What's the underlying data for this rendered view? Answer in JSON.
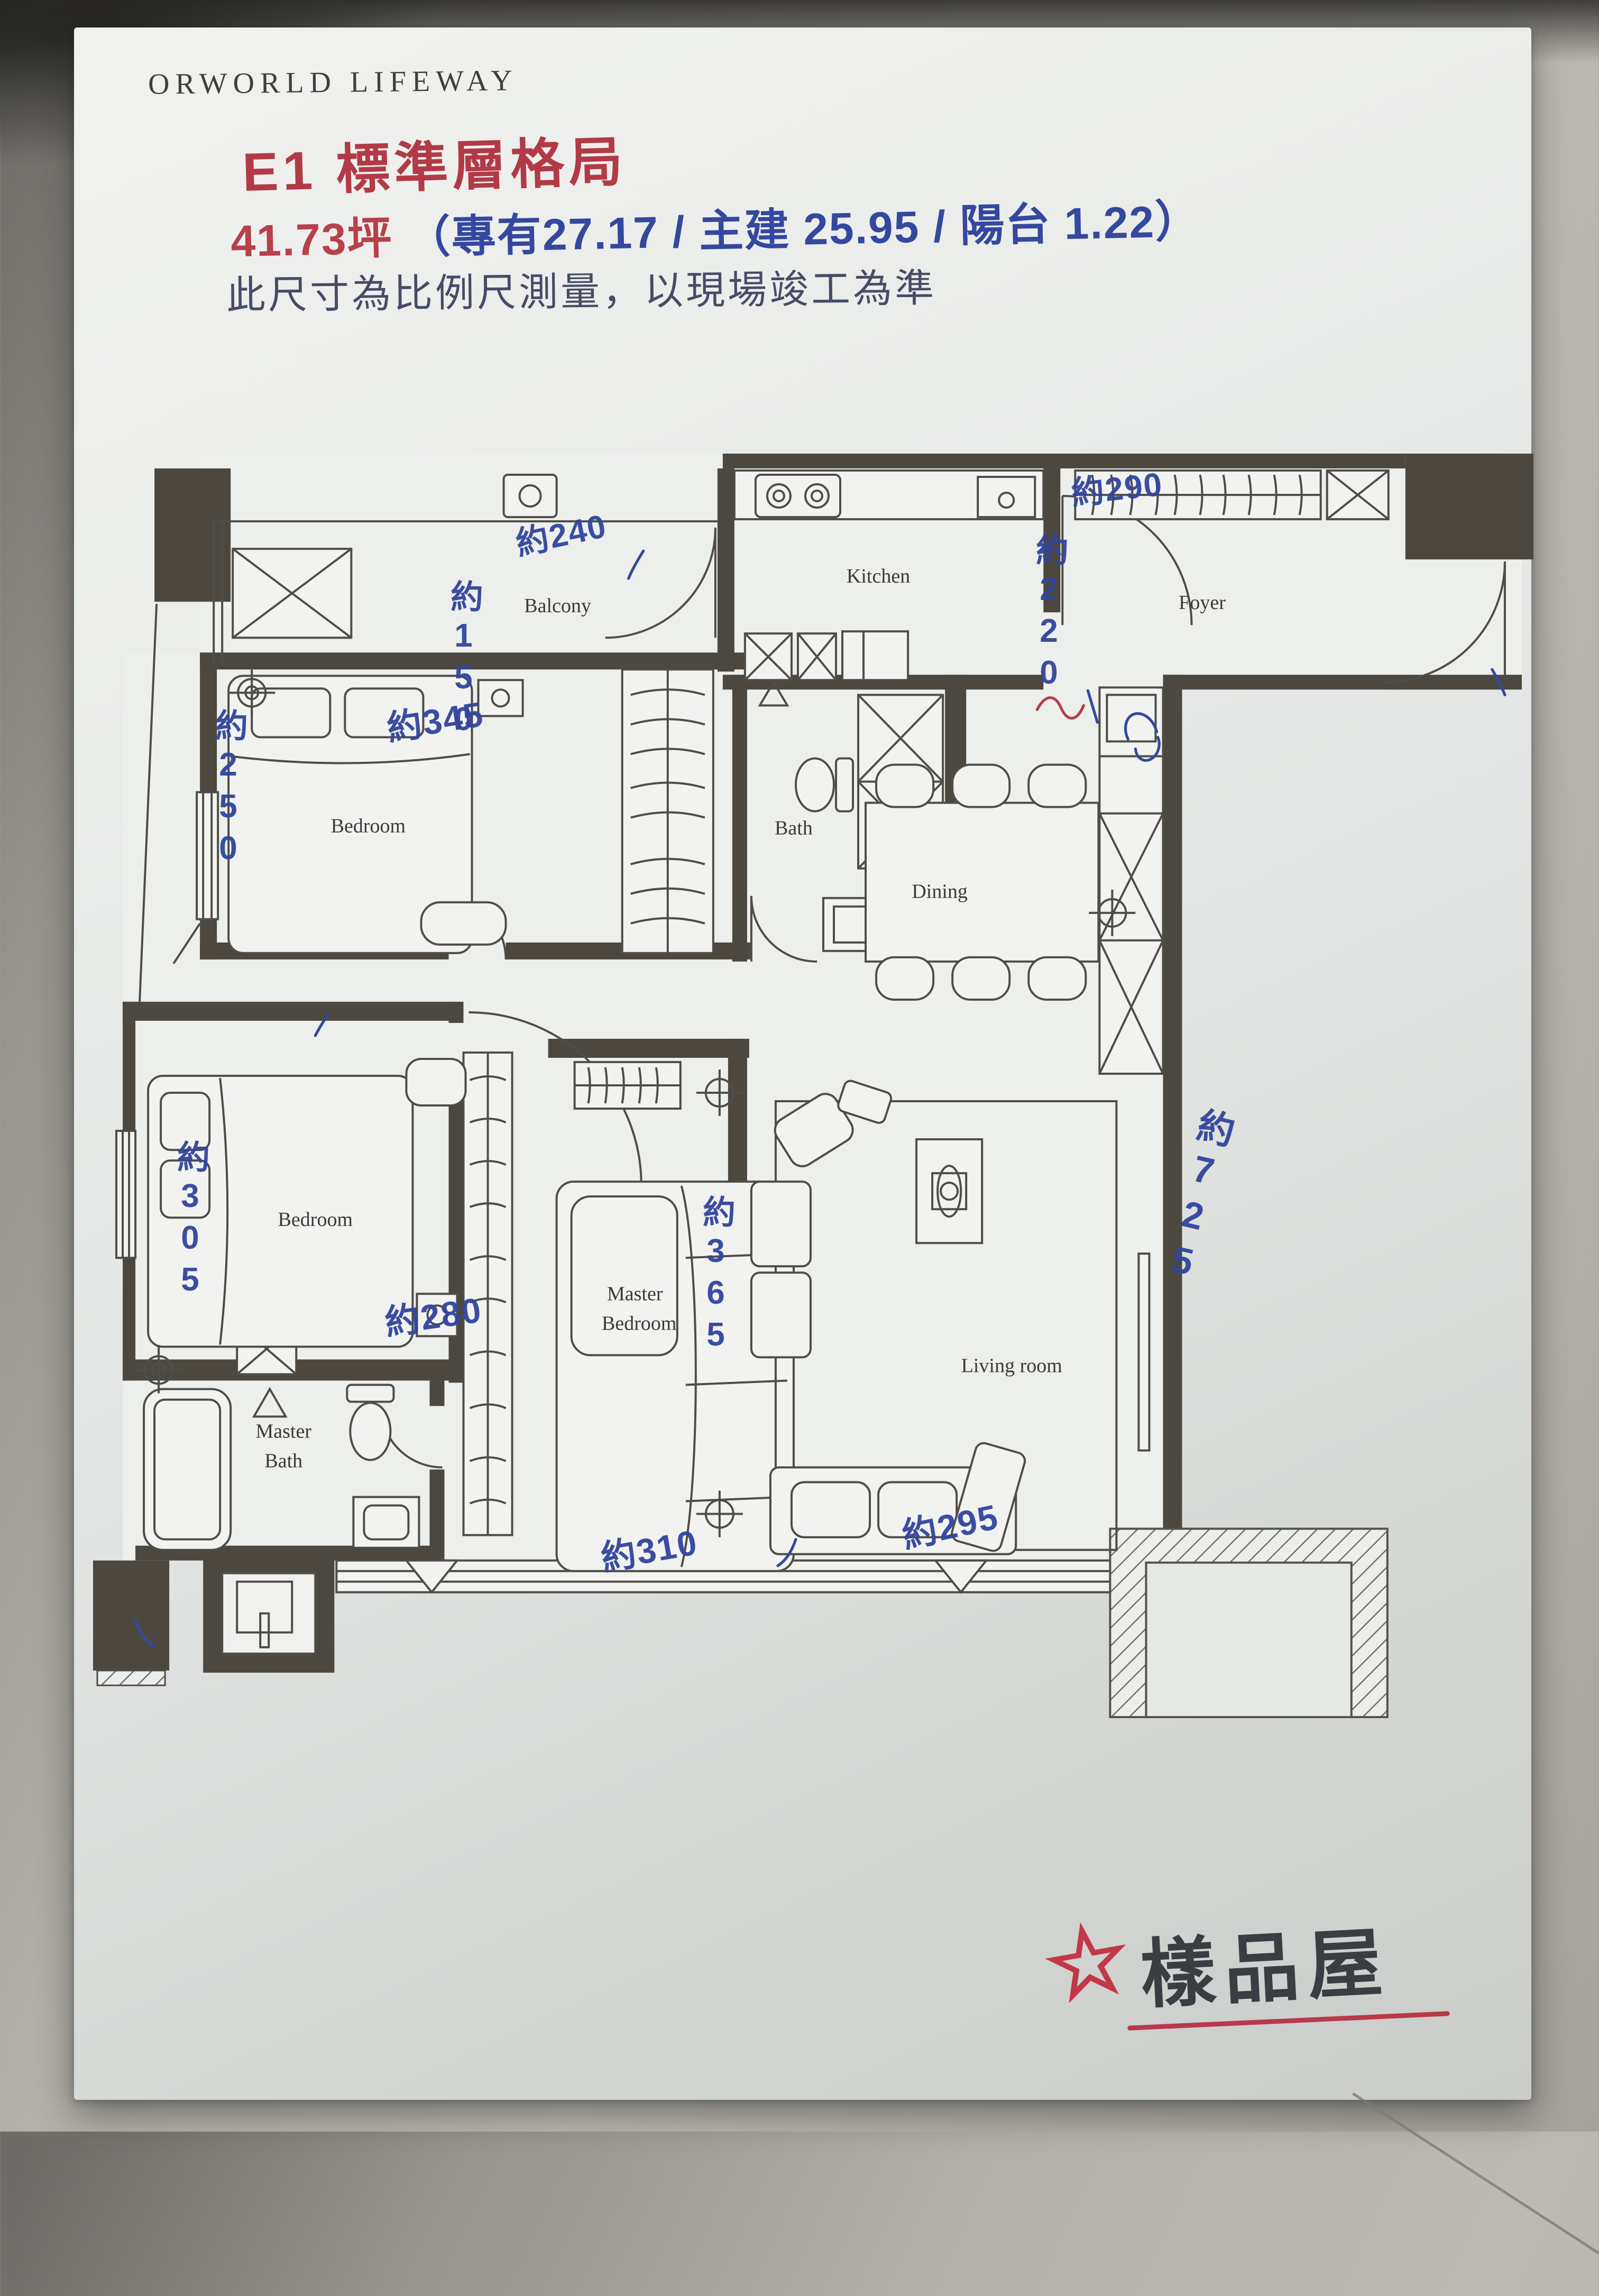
{
  "header": {
    "brand": "ORWORLD LIFEWAY",
    "title": "E1 標準層格局",
    "area_red": "41.73坪",
    "area_blue": "（專有27.17 / 主建 25.95 / 陽台 1.22）",
    "note": "此尺寸為比例尺測量，以現場竣工為準"
  },
  "plan": {
    "rooms": {
      "balcony": "Balcony",
      "kitchen": "Kitchen",
      "foyer": "Foyer",
      "bedroom1": "Bedroom",
      "bath": "Bath",
      "dining": "Dining",
      "bedroom2": "Bedroom",
      "master_bedroom_1": "Master",
      "master_bedroom_2": "Bedroom",
      "living_room": "Living room",
      "master_bath_1": "Master",
      "master_bath_2": "Bath"
    },
    "dims": {
      "d240": "約240",
      "d150": "約150",
      "d290": "約290",
      "d220": "約220",
      "d345": "約345",
      "d250": "約250",
      "d305": "約305",
      "d280": "約280",
      "d365": "約365",
      "d725": "約725",
      "d310": "約310",
      "d295": "約295"
    }
  },
  "footer": {
    "stamp": "樣品屋"
  },
  "icons": {
    "star": "☆"
  },
  "colors": {
    "pen_blue": "#35489f",
    "pen_red": "#b23a46",
    "wall": "#4c483f",
    "paper": "#e8eae8"
  }
}
